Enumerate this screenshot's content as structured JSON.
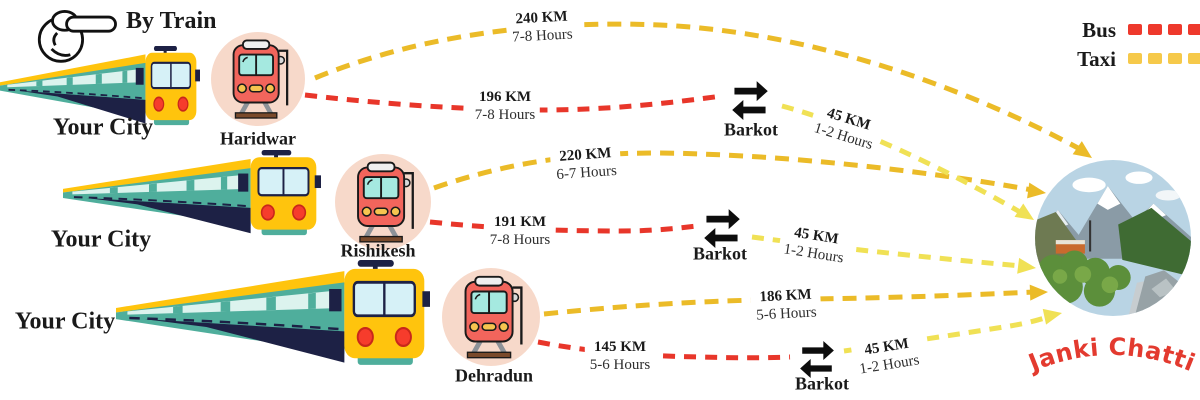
{
  "header": {
    "title": "By Train"
  },
  "legend": {
    "bus_label": "Bus",
    "taxi_label": "Taxi",
    "bus_color": "#EE392C",
    "taxi_color": "#F6C94A"
  },
  "rows": [
    {
      "origin": "Your City",
      "station": "Haridwar",
      "taxi": {
        "distance": "240 KM",
        "duration": "7-8 Hours"
      },
      "bus": {
        "distance": "196 KM",
        "duration": "7-8 Hours"
      },
      "transfer": {
        "label": "Barkot",
        "taxi": {
          "distance": "45 KM",
          "duration": "1-2 Hours"
        }
      }
    },
    {
      "origin": "Your City",
      "station": "Rishikesh",
      "taxi": {
        "distance": "220 KM",
        "duration": "6-7 Hours"
      },
      "bus": {
        "distance": "191 KM",
        "duration": "7-8 Hours"
      },
      "transfer": {
        "label": "Barkot",
        "taxi": {
          "distance": "45 KM",
          "duration": "1-2 Hours"
        }
      }
    },
    {
      "origin": "Your City",
      "station": "Dehradun",
      "taxi": {
        "distance": "186 KM",
        "duration": "5-6 Hours"
      },
      "bus": {
        "distance": "145 KM",
        "duration": "5-6 Hours"
      },
      "transfer": {
        "label": "Barkot",
        "taxi": {
          "distance": "45 KM",
          "duration": "1-2 Hours"
        }
      }
    }
  ],
  "destination": {
    "name": "Janki Chatti"
  },
  "colors": {
    "bus_route": "#E8362A",
    "taxi_route_long": "#EBBB28",
    "taxi_route_short": "#F0E155",
    "destination_text": "#E33A2F"
  }
}
